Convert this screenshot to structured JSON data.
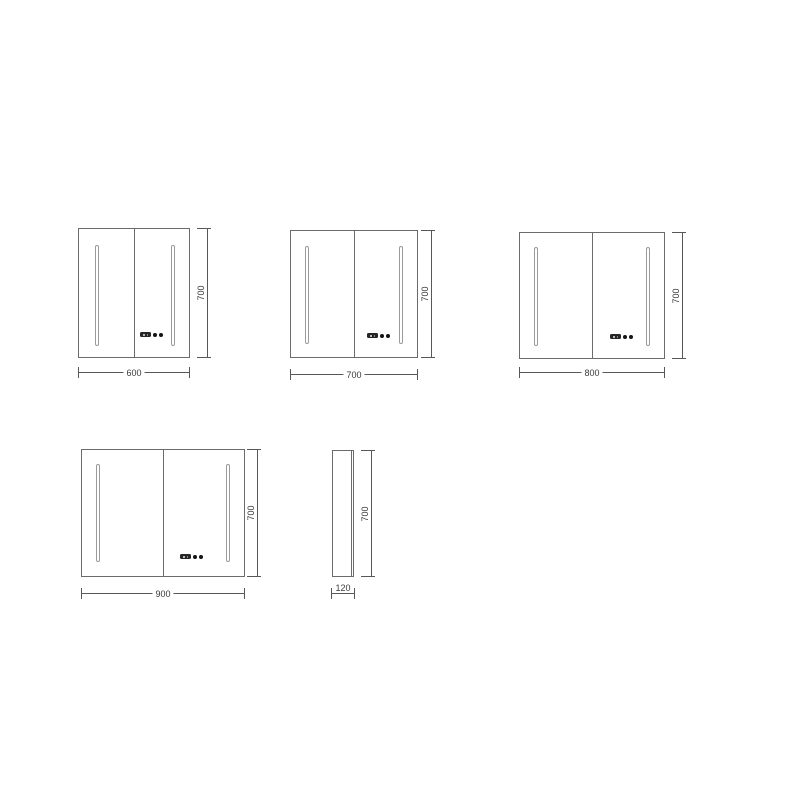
{
  "colors": {
    "background": "#ffffff",
    "cabinet_outline": "#6b6b6b",
    "led_strip_outline": "#9a9a9a",
    "dimension_line": "#585858",
    "dimension_text": "#3a3a3a",
    "control": "#141414"
  },
  "views": [
    {
      "name": "front-view-600",
      "width_label": "600",
      "height_label": "700"
    },
    {
      "name": "front-view-700",
      "width_label": "700",
      "height_label": "700"
    },
    {
      "name": "front-view-800",
      "width_label": "800",
      "height_label": "700"
    },
    {
      "name": "front-view-900",
      "width_label": "900",
      "height_label": "700"
    },
    {
      "name": "side-view-120",
      "width_label": "120",
      "height_label": "700"
    }
  ]
}
